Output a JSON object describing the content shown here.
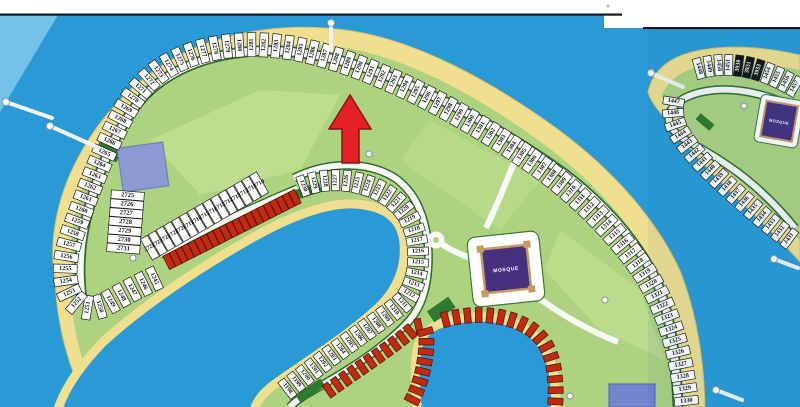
{
  "map": {
    "title": "waterfront-villa-plot-map",
    "colors": {
      "water": "#2a9ad6",
      "water_right_page": "#1f8ec9",
      "sand": "#f0df8e",
      "sand_edge": "#ddbf67",
      "green": "#aed380",
      "green_light": "#c8e49a",
      "road_white": "#f8f8f4",
      "road_edge": "#2c6e2c",
      "cell_fill": "#ffffff",
      "cell_stroke": "#1c1c1c",
      "cell_dark_fill": "#111111",
      "red_unit": "#c22b10",
      "red_unit_edge": "#58150b",
      "mosque_purple": "#46307f",
      "mosque_frame": "#c79a62",
      "amenity_blue_1": "#8e9ad4",
      "amenity_blue_2": "#7484cd",
      "arrow_red": "#e32126",
      "arrow_edge": "#8c1114",
      "scan_line": "#1a1a1a",
      "page_white": "#ffffff"
    },
    "mosques": [
      {
        "label": "MOSQUE"
      },
      {
        "label": "MOSQUE"
      }
    ],
    "pointer": {
      "points_at_plot": "1288"
    },
    "plot_rows": [
      {
        "name": "outer-ring",
        "labels": [
          "1245",
          "1246",
          "1247",
          "1248",
          "1249",
          "1250",
          "1251",
          "1252",
          "1253",
          "1254",
          "1255",
          "1256",
          "1257",
          "1258",
          "1259",
          "1260",
          "1261",
          "1262",
          "1263",
          "1264",
          "1265",
          "1266",
          "1267",
          "1268",
          "1269",
          "1270",
          "1271",
          "1272",
          "1273",
          "1274",
          "1275",
          "1276",
          "1277",
          "1278",
          "1279",
          "1280",
          "1281",
          "1282",
          "1283",
          "1284",
          "1285",
          "1286",
          "1287",
          "1288",
          "1289",
          "1290",
          "1291",
          "1292",
          "1293",
          "1294",
          "1295",
          "1296",
          "1297",
          "1298",
          "1299",
          "1300",
          "1301",
          "1302",
          "1303",
          "1304",
          "1305",
          "1306",
          "1307",
          "1308",
          "1309",
          "1310",
          "1311",
          "1312",
          "1313",
          "1314",
          "1315",
          "1316",
          "1317",
          "1318",
          "1319",
          "1320",
          "1321",
          "1322",
          "1323",
          "1324",
          "1325",
          "1326",
          "1327",
          "1328",
          "1329",
          "1330"
        ],
        "dark": []
      },
      {
        "name": "inner-ring",
        "labels": [
          "1198",
          "1199",
          "1200",
          "1201",
          "1202",
          "1203",
          "1204",
          "1205",
          "1206",
          "1207",
          "1208",
          "1209",
          "1210",
          "1211",
          "1212",
          "1213",
          "1214",
          "1215",
          "1216",
          "1217",
          "1218",
          "1219",
          "1220",
          "1221",
          "1222",
          "1223",
          "1224",
          "1225",
          "1226",
          "1227",
          "1228",
          "1229",
          "1230"
        ],
        "dark": []
      },
      {
        "name": "block-2725",
        "labels": [
          "2725",
          "2726",
          "2727",
          "2728",
          "2729",
          "2730",
          "2731"
        ],
        "dark": []
      },
      {
        "name": "block-2715",
        "labels": [
          "2724",
          "2723",
          "2722",
          "2721",
          "2720",
          "2719",
          "2718",
          "2717",
          "2716",
          "2715",
          "2714",
          "2713",
          "2712",
          "2711",
          "2710"
        ],
        "dark": []
      },
      {
        "name": "island2-left",
        "labels": [
          "1447",
          "1446",
          "1445",
          "1444",
          "1443",
          "1442",
          "1441",
          "1440",
          "1439",
          "1438",
          "1437",
          "1436",
          "1435",
          "1434",
          "1433",
          "1432",
          "1431"
        ],
        "dark": []
      },
      {
        "name": "island2-top",
        "labels": [
          "1448",
          "1449",
          "1450",
          "1451",
          "3930",
          "3931",
          "3933",
          "1454",
          "1455",
          "1456",
          "1457"
        ],
        "dark": [
          "3930",
          "3931",
          "3933"
        ]
      }
    ]
  }
}
